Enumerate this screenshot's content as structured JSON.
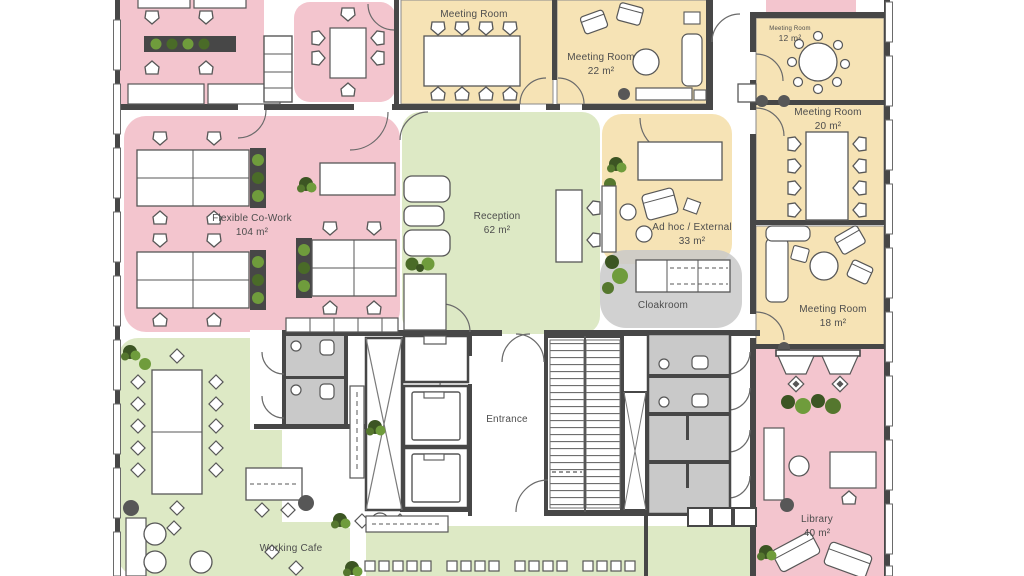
{
  "title": "Office floor plan",
  "colors": {
    "open_office_pink": "#f3c5ce",
    "meeting_yellow": "#f6e3b5",
    "public_green": "#dde9c5",
    "service_gray": "#c9c9c9",
    "wall_dark": "#474747",
    "furniture_stroke": "#575757",
    "plant_green": "#6f9c3c",
    "plant_dark": "#3c5523",
    "label_text": "#4d4d4d"
  },
  "rooms": [
    {
      "id": "meeting-room-top-a",
      "label": "Meeting Room",
      "area": ""
    },
    {
      "id": "meeting-room-top-b",
      "label": "Meeting Room",
      "area": "22 m²"
    },
    {
      "id": "meeting-room-small",
      "label": "Meeting Room",
      "area": "12 m²"
    },
    {
      "id": "meeting-room-mid",
      "label": "Meeting Room",
      "area": "20 m²"
    },
    {
      "id": "meeting-room-lounge",
      "label": "Meeting Room",
      "area": "18 m²"
    },
    {
      "id": "flexible-cowork",
      "label": "Flexible Co-Work",
      "area": "104 m²"
    },
    {
      "id": "reception",
      "label": "Reception",
      "area": "62 m²"
    },
    {
      "id": "adhoc-external",
      "label": "Ad hoc / External",
      "area": "33 m²"
    },
    {
      "id": "cloakroom",
      "label": "Cloakroom",
      "area": ""
    },
    {
      "id": "entrance",
      "label": "Entrance",
      "area": ""
    },
    {
      "id": "working-cafe",
      "label": "Working Cafe",
      "area": ""
    },
    {
      "id": "library",
      "label": "Library",
      "area": "40 m²"
    }
  ]
}
